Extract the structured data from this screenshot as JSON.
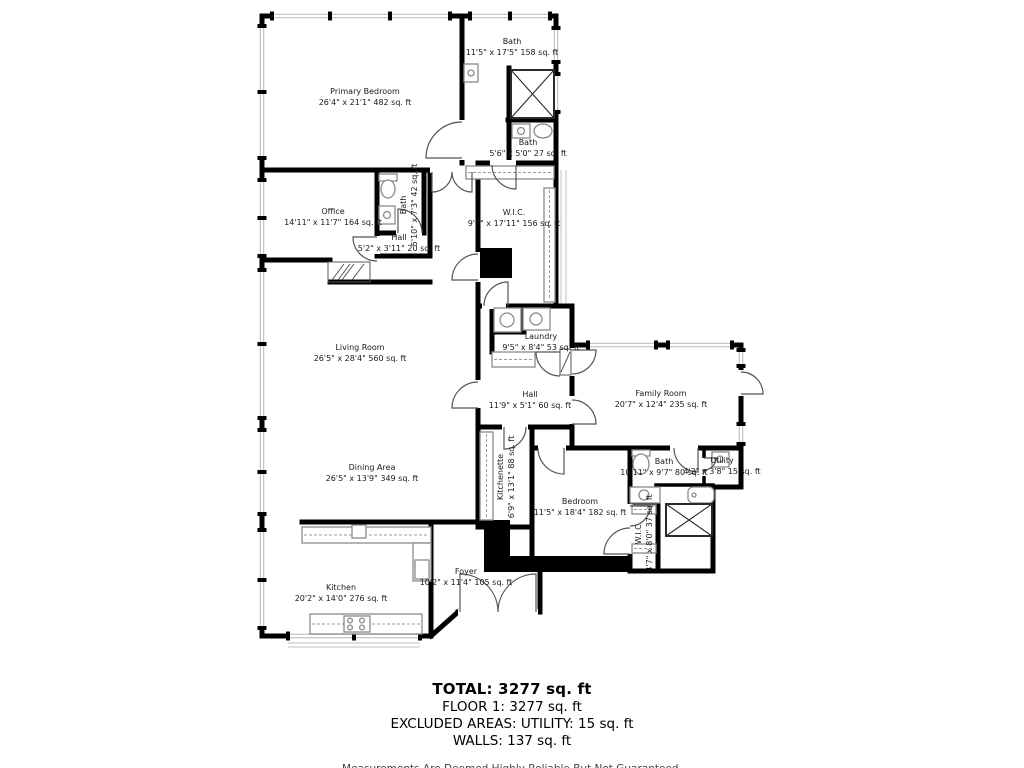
{
  "colors": {
    "wall": "#000000",
    "window": "#b5b5b5",
    "fixture": "#8a8a8a",
    "background": "#ffffff"
  },
  "rooms": [
    {
      "id": "primary-bedroom",
      "name": "Primary Bedroom",
      "dims": "26'4\" x 21'1\" 482 sq. ft"
    },
    {
      "id": "bath-primary",
      "name": "Bath",
      "dims": "11'5\" x 17'5\" 158 sq. ft"
    },
    {
      "id": "bath-small",
      "name": "Bath",
      "dims": "5'6\" x 5'0\" 27 sq. ft"
    },
    {
      "id": "office",
      "name": "Office",
      "dims": "14'11\" x 11'7\" 164 sq. ft"
    },
    {
      "id": "bath-office",
      "name": "Bath",
      "dims": "5'10\" x 7'3\" 42 sq. ft"
    },
    {
      "id": "hall-upper",
      "name": "Hall",
      "dims": "5'2\" x 3'11\" 20 sq. ft"
    },
    {
      "id": "wic-primary",
      "name": "W.I.C.",
      "dims": "9'7\" x 17'11\" 156 sq. ft"
    },
    {
      "id": "living-room",
      "name": "Living Room",
      "dims": "26'5\" x 28'4\" 560 sq. ft"
    },
    {
      "id": "laundry",
      "name": "Laundry",
      "dims": "9'5\" x 8'4\" 53 sq. ft"
    },
    {
      "id": "hall-main",
      "name": "Hall",
      "dims": "11'9\" x 5'1\" 60 sq. ft"
    },
    {
      "id": "family-room",
      "name": "Family Room",
      "dims": "20'7\" x 12'4\" 235 sq. ft"
    },
    {
      "id": "bath-main",
      "name": "Bath",
      "dims": "10'11\" x 9'7\" 80 sq. ft"
    },
    {
      "id": "utility",
      "name": "Utility",
      "dims": "4'2\" x 3'8\" 15 sq. ft"
    },
    {
      "id": "kitchenette",
      "name": "Kitchenette",
      "dims": "6'9\" x 13'1\" 88 sq. ft"
    },
    {
      "id": "bedroom",
      "name": "Bedroom",
      "dims": "11'5\" x 18'4\" 182 sq. ft"
    },
    {
      "id": "wic-bedroom",
      "name": "W.I.C.",
      "dims": "4'7\" x 8'0\" 37 sq. ft"
    },
    {
      "id": "dining-area",
      "name": "Dining Area",
      "dims": "26'5\" x 13'9\" 349 sq. ft"
    },
    {
      "id": "kitchen",
      "name": "Kitchen",
      "dims": "20'2\" x 14'0\" 276 sq. ft"
    },
    {
      "id": "foyer",
      "name": "Foyer",
      "dims": "10'2\" x 11'4\" 105 sq. ft"
    }
  ],
  "summary": {
    "total": "TOTAL: 3277 sq. ft",
    "floor": "FLOOR 1: 3277 sq. ft",
    "excluded": "EXCLUDED AREAS: UTILITY: 15 sq. ft",
    "walls": "WALLS: 137 sq. ft",
    "disclaimer": "Measurements Are Deemed Highly Reliable But Not Guaranteed."
  }
}
